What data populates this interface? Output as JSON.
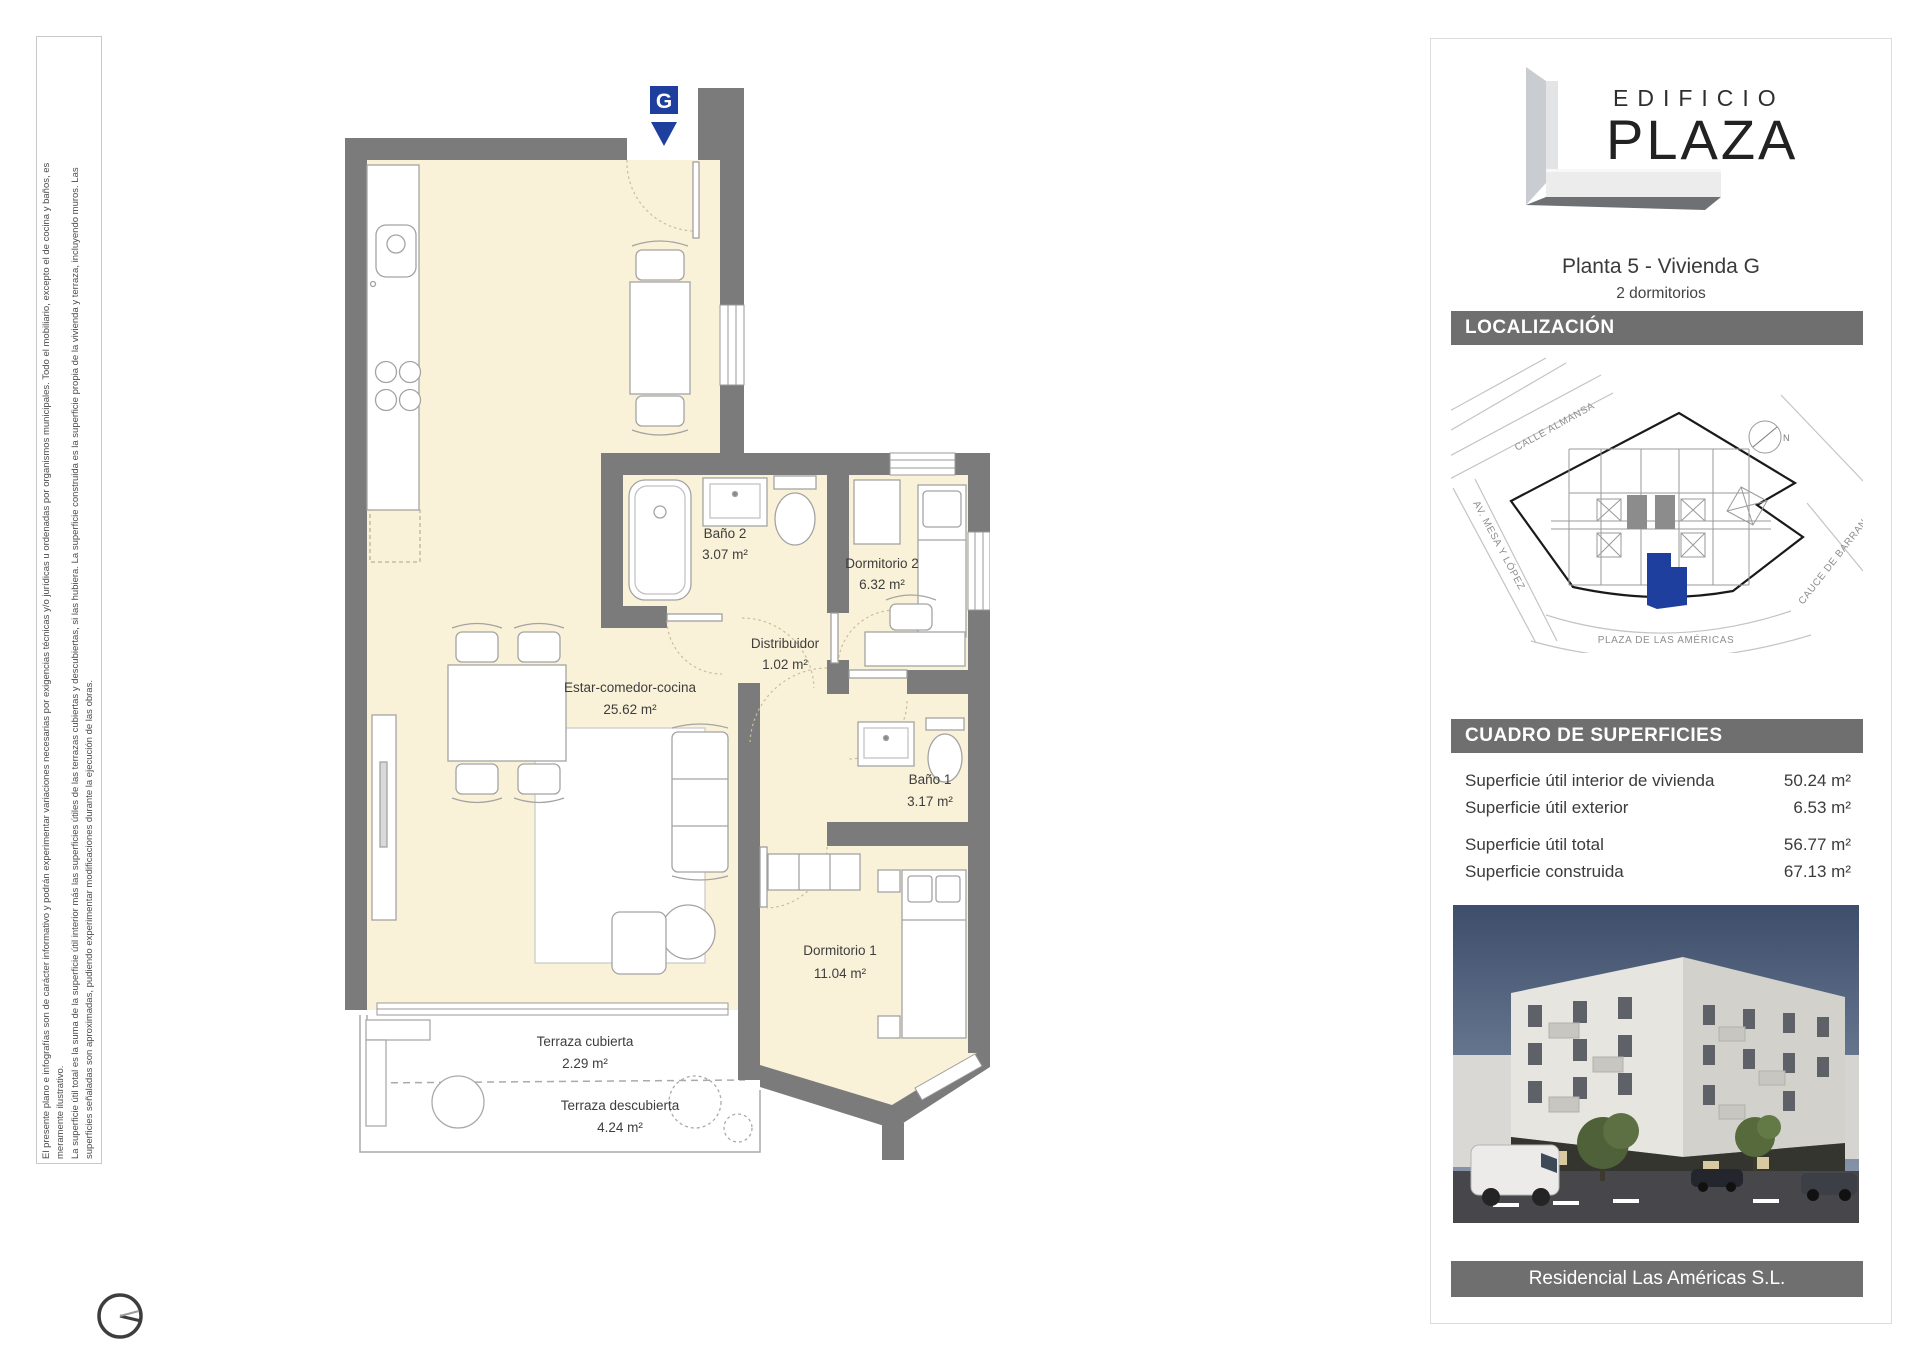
{
  "disclaimer": {
    "lines": [
      "El presente plano e infografías son de carácter informativo y podrán experimentar variaciones necesarias por exigencias técnicas y/o jurídicas u ordenadas por organismos municipales. Todo el mobiliario, excepto el de cocina y baños, es",
      "meramente ilustrativo.",
      "La superficie útil total es la suma de la superficie útil interior más las superficies útiles de las terrazas cubiertas y descubiertas, si las hubiera. La superficie construida es la superficie propia de la vivienda y terraza, incluyendo muros. Las",
      "superficies señaladas son aproximadas, pudiendo experimentar modificaciones durante la ejecución de las obras."
    ]
  },
  "plan": {
    "entrance_marker": "G",
    "marker_color": "#1e3f9e",
    "wall_color": "#7b7b7b",
    "floor_color": "#faf2d8",
    "rooms": [
      {
        "name": "Baño 2",
        "area": "3.07 m²"
      },
      {
        "name": "Dormitorio 2",
        "area": "6.32 m²"
      },
      {
        "name": "Distribuidor",
        "area": "1.02 m²"
      },
      {
        "name": "Estar-comedor-cocina",
        "area": "25.62 m²"
      },
      {
        "name": "Baño 1",
        "area": "3.17 m²"
      },
      {
        "name": "Dormitorio 1",
        "area": "11.04 m²"
      },
      {
        "name": "Terraza cubierta",
        "area": "2.29 m²"
      },
      {
        "name": "Terraza descubierta",
        "area": "4.24 m²"
      }
    ]
  },
  "sidebar": {
    "logo": {
      "line1": "EDIFICIO",
      "line2": "PLAZA"
    },
    "unit_title": "Planta 5  -  Vivienda G",
    "unit_subtitle": "2 dormitorios",
    "sections": {
      "location": "LOCALIZACIÓN",
      "surfaces": "CUADRO DE SUPERFICIES"
    },
    "map": {
      "streets": [
        "CALLE ALMANSA",
        "AV. MESA Y LÓPEZ",
        "CAUCE DE BARRANCO",
        "PLAZA DE LAS AMÉRICAS"
      ],
      "north": "N",
      "highlight_color": "#1e3f9e"
    },
    "surfaces_table": {
      "rows": [
        {
          "label": "Superficie útil interior de vivienda",
          "value": "50.24 m²"
        },
        {
          "label": "Superficie útil exterior",
          "value": "6.53 m²"
        },
        {
          "label": "Superficie útil total",
          "value": "56.77 m²"
        },
        {
          "label": "Superficie construida",
          "value": "67.13 m²"
        }
      ]
    },
    "footer": "Residencial Las Américas S.L."
  }
}
